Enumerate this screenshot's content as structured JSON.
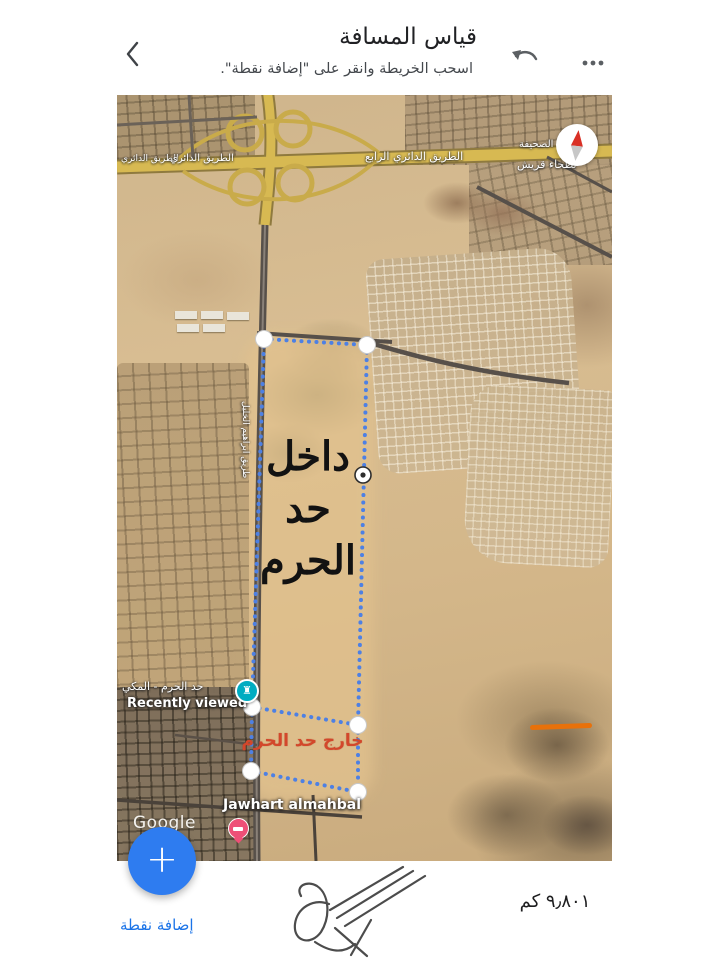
{
  "header": {
    "title": "قياس المسافة",
    "subtitle": "اسحب الخريطة وانقر على \"إضافة نقطة\".",
    "icons": {
      "back": "chevron-left",
      "undo": "undo-arrow",
      "more": "three-dots-horizontal"
    }
  },
  "map": {
    "road_labels": {
      "ring_road_far_left": "الطريق الدائري",
      "ring_road_left": "الطريق الدائري",
      "fourth_ring_road": "الطريق الدائري الرابع",
      "district_upper": "الصحيفة",
      "district_lower": "بطحاء قريش",
      "street_vertical": "طريق ابراهيم الخليل"
    },
    "annotations": {
      "inside_lines": [
        "داخل",
        "حد",
        "الحرم"
      ],
      "outside_text": "خارج حد الحرم"
    },
    "places": {
      "boundary_place": "حد الحرم - المكي",
      "recently_viewed": "Recently viewed",
      "bottom_place": "Jawhart almahbal"
    },
    "watermark": "Google",
    "measure": {
      "vertex_count": 6
    },
    "icons": {
      "compass": "compass-needle",
      "landmark": "landmark-rook",
      "hotel_pin": "bed-pin"
    },
    "colors": {
      "measure_line": "#4d80e4",
      "outside_text": "#d3472b",
      "landmark_icon": "#00acc1",
      "hotel_pin": "#ee4f77",
      "compass_north": "#d93025",
      "closed_road": "#e8710a"
    }
  },
  "footer": {
    "distance": "٩٫٨٠١ كم",
    "add_point": "إضافة نقطة",
    "fab_glyph": "+",
    "colors": {
      "fab": "#2e7cf0",
      "link_blue": "#1a73e8"
    }
  }
}
